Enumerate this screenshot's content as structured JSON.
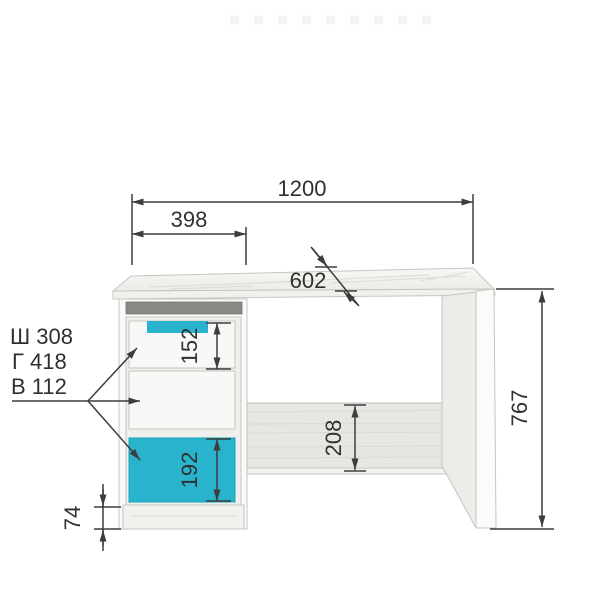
{
  "drawing": {
    "kind": "furniture-dimension-diagram",
    "item": "desk-with-drawer-pedestal"
  },
  "dims": {
    "total_width": "1200",
    "pedestal_width": "398",
    "top_depth": "602",
    "drawer_top_height": "152",
    "drawer_bottom_height": "192",
    "back_panel_height": "208",
    "total_height": "767",
    "plinth_height": "74"
  },
  "drawer_specs": {
    "width_label": "Ш 308",
    "depth_label": "Г 418",
    "height_label": "В 112"
  },
  "colors": {
    "accent": "#29b3cd",
    "accent_edge": "#17a0ba",
    "dimension_line": "#3d3d3d",
    "niche_shadow": "#898985",
    "wood_light": "#ecece8"
  }
}
